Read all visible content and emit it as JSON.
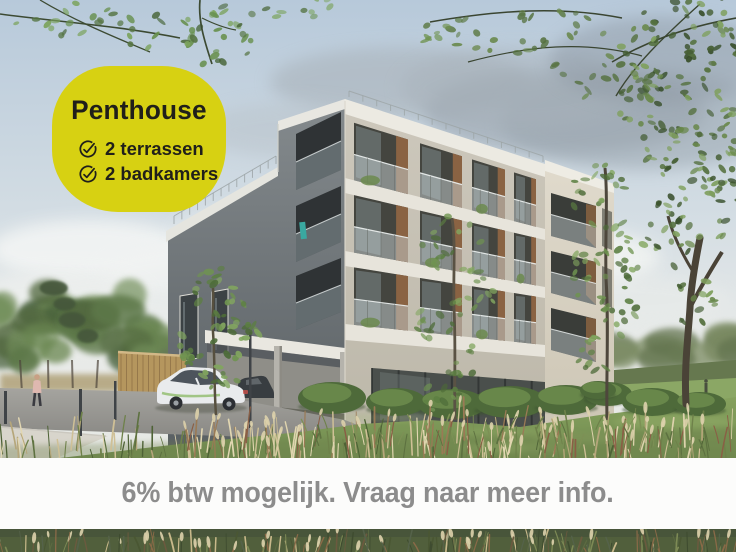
{
  "badge": {
    "title": "Penthouse",
    "features": [
      {
        "icon": "check-circle-icon",
        "label": "2 terrassen"
      },
      {
        "icon": "check-circle-icon",
        "label": "2 badkamers"
      }
    ],
    "background_color": "#d7d112",
    "text_color": "#201f1a"
  },
  "banner": {
    "text": "6% btw mogelijk. Vraag naar meer info.",
    "text_color": "#8c8c8c",
    "background_color": "#fcfcfb"
  },
  "scene": {
    "description": "Architectural render of a modern four-storey apartment building with balconies seen from its corner, with lawns, rounded shrubs, ornamental grasses, young trees, overhanging branches, a carport and a parked white car.",
    "palette": {
      "sky": "#c3d3e0",
      "front_facade": "#c6c1b4",
      "dark_side_facade": "#676d70",
      "cream_side_facade": "#d8d2c4",
      "lawn": "#6f8c50"
    }
  }
}
